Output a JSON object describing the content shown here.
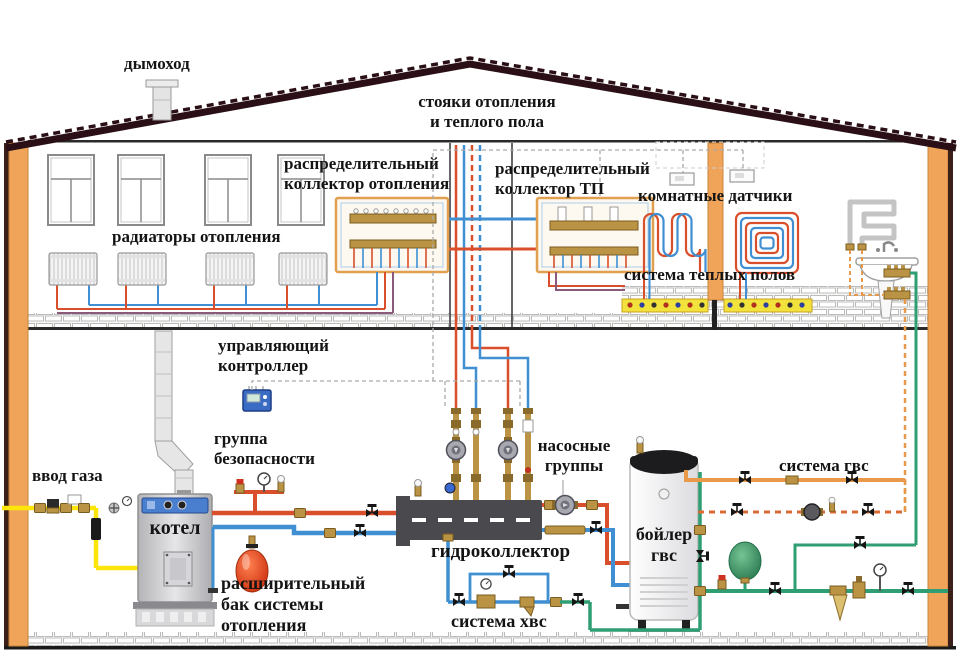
{
  "labels": {
    "chimney": "дымоход",
    "risers": "стояки отопления\nи теплого пола",
    "collector_heating": "распределительный\nколлектор отопления",
    "collector_tp": "распределительный\nколлектор ТП",
    "room_sensors": "комнатные датчики",
    "radiators": "радиаторы отопления",
    "warm_floor": "система теплых полов",
    "controller": "управляющий\nконтроллер",
    "safety_group": "группа\nбезопасности",
    "pump_groups": "насосные\nгруппы",
    "dhw_system": "система гвс",
    "gas_inlet": "ввод газа",
    "boiler": "котел",
    "hydrocollector": "гидроколлектор",
    "dhw_boiler": "бойлер\nгвс",
    "expansion_tank": "расширительный\nбак системы\nотопления",
    "cold_water_system": "система хвс"
  },
  "colors": {
    "red": "#d94f2b",
    "blue": "#3f8fd2",
    "purple": "#8a5a7a",
    "gas": "#ffe60a",
    "green": "#2f9e72",
    "orange": "#e89a4a",
    "recirc": "#d96a35",
    "brass": "#bb9345",
    "wall": "#f0a45a",
    "roof": "#2a1016",
    "wire": "#aaaaaa",
    "floor_yellow": "#f2e23c"
  }
}
